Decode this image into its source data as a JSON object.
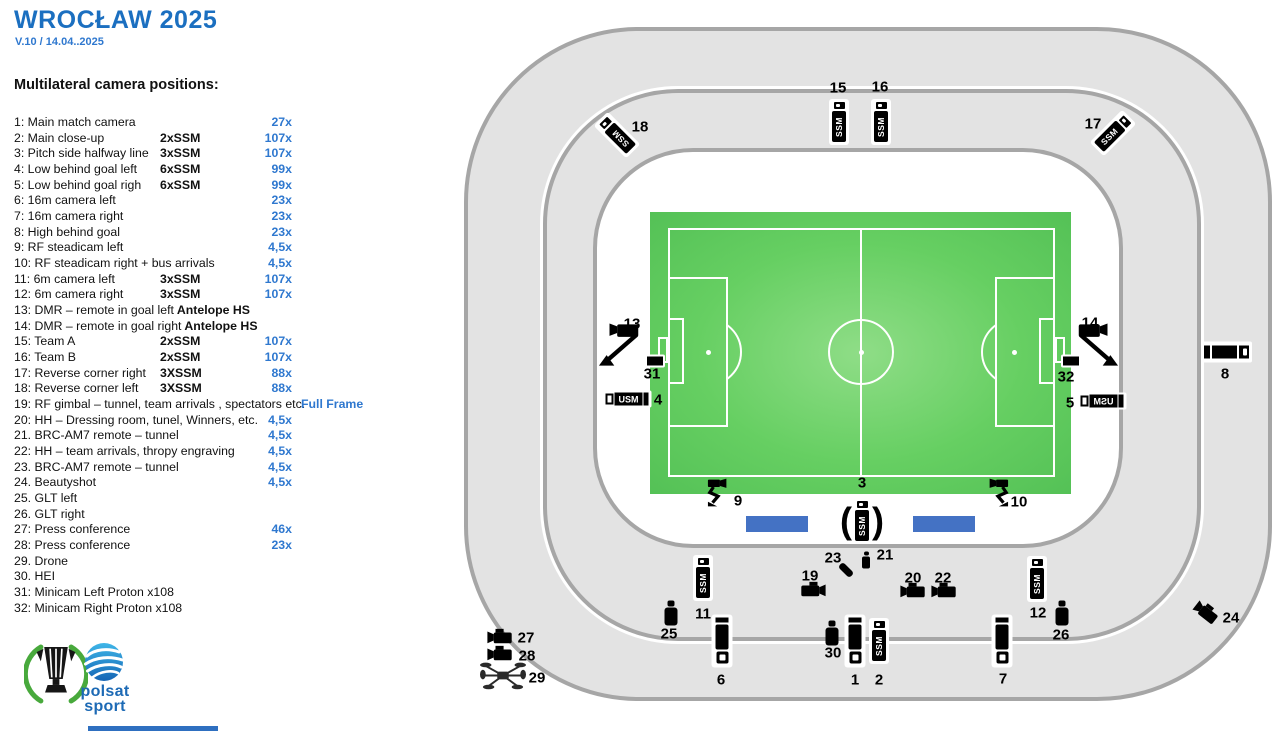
{
  "header": {
    "title": "WROCŁAW 2025",
    "version": "V.10 / 14.04..2025"
  },
  "list": {
    "heading": "Multilateral camera positions:",
    "rows": [
      {
        "n": "1:",
        "name": "Main match camera",
        "spec": "",
        "value": "27x"
      },
      {
        "n": "2:",
        "name": "Main close-up",
        "spec": "2xSSM",
        "value": "107x"
      },
      {
        "n": "3:",
        "name": "Pitch side halfway line",
        "spec": "3xSSM",
        "value": "107x"
      },
      {
        "n": "4:",
        "name": "Low behind goal left",
        "spec": "6xSSM",
        "value": "99x"
      },
      {
        "n": "5:",
        "name": "Low behind goal righ",
        "spec": "6xSSM",
        "value": "99x"
      },
      {
        "n": "6:",
        "name": "16m camera left",
        "spec": "",
        "value": "23x"
      },
      {
        "n": "7:",
        "name": "16m camera right",
        "spec": "",
        "value": "23x"
      },
      {
        "n": "8:",
        "name": "High behind goal",
        "spec": "",
        "value": "23x"
      },
      {
        "n": "9:",
        "name": "RF steadicam left",
        "spec": "",
        "value": "4,5x"
      },
      {
        "n": "10:",
        "name": "RF steadicam right + bus arrivals",
        "spec": "",
        "value": "4,5x"
      },
      {
        "n": "11:",
        "name": "6m camera left",
        "spec": "3xSSM",
        "value": "107x"
      },
      {
        "n": "12:",
        "name": "6m camera right",
        "spec": "3xSSM",
        "value": "107x"
      },
      {
        "n": "13:",
        "name": "DMR – remote in goal left",
        "suffix": " Antelope HS",
        "spec": "",
        "value": ""
      },
      {
        "n": "14:",
        "name": "DMR – remote in goal right",
        "suffix": " Antelope HS",
        "spec": "",
        "value": ""
      },
      {
        "n": "15:",
        "name": "Team A",
        "spec": "2xSSM",
        "value": "107x"
      },
      {
        "n": "16:",
        "name": "Team B",
        "spec": "2xSSM",
        "value": "107x"
      },
      {
        "n": "17:",
        "name": "Reverse corner right",
        "spec": "3XSSM",
        "value": "88x"
      },
      {
        "n": "18:",
        "name": "Reverse corner left",
        "spec": "3XSSM",
        "value": "88x"
      },
      {
        "n": "19:",
        "name": "RF gimbal – tunnel, team arrivals , spectators etc.",
        "spec": "",
        "value": "Full Frame",
        "wide": true
      },
      {
        "n": "20:",
        "name": "HH – Dressing room, tunel, Winners, etc.",
        "spec": "",
        "value": "4,5x"
      },
      {
        "n": "21.",
        "name": "BRC-AM7 remote – tunnel",
        "spec": "",
        "value": "4,5x"
      },
      {
        "n": "22:",
        "name": "HH – team arrivals, thropy engraving",
        "spec": "",
        "value": "4,5x"
      },
      {
        "n": "23.",
        "name": "BRC-AM7 remote – tunnel",
        "spec": "",
        "value": "4,5x"
      },
      {
        "n": "24.",
        "name": "Beautyshot",
        "spec": "",
        "value": "4,5x"
      },
      {
        "n": "25.",
        "name": "GLT left",
        "spec": "",
        "value": ""
      },
      {
        "n": "26.",
        "name": "GLT right",
        "spec": "",
        "value": ""
      },
      {
        "n": "27:",
        "name": "Press conference",
        "spec": "",
        "value": "46x"
      },
      {
        "n": "28:",
        "name": "Press conference",
        "spec": "",
        "value": "23x"
      },
      {
        "n": "29.",
        "name": "Drone",
        "spec": "",
        "value": ""
      },
      {
        "n": "30.",
        "name": "HEI",
        "spec": "",
        "value": ""
      },
      {
        "n": "31:",
        "name": "Minicam Left Proton x108",
        "spec": "",
        "value": ""
      },
      {
        "n": "32:",
        "name": "Minicam Right Proton x108",
        "spec": "",
        "value": ""
      }
    ]
  },
  "colors": {
    "title_blue": "#1b6fc0",
    "value_blue": "#2f78cf",
    "bench_blue": "#4472c4",
    "pitch_green": "#5ec95e",
    "stand_gray": "#e3e3e3",
    "stand_border_gray": "#a6a6a6"
  },
  "stadium": {
    "ssm_label": "SSM",
    "usm_label": "USM",
    "benches": [
      {
        "x": 746,
        "y": 516,
        "w": 62,
        "h": 16
      },
      {
        "x": 913,
        "y": 516,
        "w": 62,
        "h": 16
      }
    ],
    "cameras": [
      {
        "num": "1",
        "type": "bigcam",
        "x": 855,
        "y": 641,
        "lx": 855,
        "ly": 680
      },
      {
        "num": "2",
        "type": "ssmv",
        "x": 879,
        "y": 641,
        "lx": 879,
        "ly": 680
      },
      {
        "num": "3",
        "type": "ssmv_paren",
        "x": 862,
        "y": 521,
        "lx": 862,
        "ly": 483
      },
      {
        "num": "4",
        "type": "usmh",
        "x": 627,
        "y": 399,
        "lx": 658,
        "ly": 400
      },
      {
        "num": "5",
        "type": "usmh",
        "flip": true,
        "x": 1102,
        "y": 401,
        "lx": 1070,
        "ly": 403
      },
      {
        "num": "6",
        "type": "bigcam",
        "x": 722,
        "y": 641,
        "lx": 721,
        "ly": 680
      },
      {
        "num": "7",
        "type": "bigcam",
        "x": 1002,
        "y": 641,
        "lx": 1003,
        "ly": 679
      },
      {
        "num": "8",
        "type": "cam8",
        "x": 1227,
        "y": 352,
        "lx": 1225,
        "ly": 374
      },
      {
        "num": "9",
        "type": "steadicam",
        "x": 719,
        "y": 495,
        "lx": 738,
        "ly": 501
      },
      {
        "num": "10",
        "type": "steadicam",
        "flip": true,
        "x": 997,
        "y": 495,
        "lx": 1019,
        "ly": 502
      },
      {
        "num": "11",
        "type": "ssmv",
        "x": 703,
        "y": 578,
        "lx": 703,
        "ly": 614
      },
      {
        "num": "12",
        "type": "ssmv",
        "x": 1037,
        "y": 579,
        "lx": 1038,
        "ly": 613
      },
      {
        "num": "13",
        "type": "tripod",
        "x": 621,
        "y": 348,
        "lx": 632,
        "ly": 324
      },
      {
        "num": "14",
        "type": "tripod",
        "flip": true,
        "x": 1096,
        "y": 348,
        "lx": 1090,
        "ly": 323
      },
      {
        "num": "15",
        "type": "ssmv",
        "x": 839,
        "y": 122,
        "lx": 838,
        "ly": 88
      },
      {
        "num": "16",
        "type": "ssmv",
        "x": 881,
        "y": 122,
        "lx": 880,
        "ly": 87
      },
      {
        "num": "17",
        "type": "ssmv",
        "rot": 45,
        "x": 1113,
        "y": 133,
        "lx": 1093,
        "ly": 124
      },
      {
        "num": "18",
        "type": "ssmv",
        "rot": -45,
        "x": 617,
        "y": 135,
        "lx": 640,
        "ly": 127
      },
      {
        "num": "19",
        "type": "camcorder",
        "dir": "r",
        "x": 813,
        "y": 592,
        "lx": 810,
        "ly": 576
      },
      {
        "num": "20",
        "type": "camcorder",
        "dir": "l",
        "x": 913,
        "y": 593,
        "lx": 913,
        "ly": 578
      },
      {
        "num": "21",
        "type": "mic",
        "x": 866,
        "y": 560,
        "lx": 885,
        "ly": 555
      },
      {
        "num": "22",
        "type": "camcorder",
        "dir": "l",
        "x": 944,
        "y": 593,
        "lx": 943,
        "ly": 578
      },
      {
        "num": "23",
        "type": "pilld",
        "x": 846,
        "y": 570,
        "lx": 833,
        "ly": 558
      },
      {
        "num": "24",
        "type": "camcorder",
        "dir": "l",
        "rot": 38,
        "x": 1205,
        "y": 614,
        "lx": 1231,
        "ly": 618
      },
      {
        "num": "25",
        "type": "bottle",
        "x": 671,
        "y": 613,
        "lx": 669,
        "ly": 634
      },
      {
        "num": "26",
        "type": "bottle",
        "x": 1062,
        "y": 613,
        "lx": 1061,
        "ly": 635
      },
      {
        "num": "27",
        "type": "camcorder",
        "dir": "l",
        "x": 500,
        "y": 639,
        "lx": 526,
        "ly": 638
      },
      {
        "num": "28",
        "type": "camcorder",
        "dir": "l",
        "x": 500,
        "y": 656,
        "lx": 527,
        "ly": 656
      },
      {
        "num": "29",
        "type": "drone",
        "x": 503,
        "y": 678,
        "lx": 537,
        "ly": 678
      },
      {
        "num": "30",
        "type": "bottle",
        "x": 832,
        "y": 633,
        "lx": 833,
        "ly": 653
      },
      {
        "num": "31",
        "type": "minicam",
        "x": 655,
        "y": 361,
        "lx": 652,
        "ly": 374
      },
      {
        "num": "32",
        "type": "minicam",
        "x": 1071,
        "y": 361,
        "lx": 1066,
        "ly": 377
      }
    ]
  },
  "logos": {
    "conference_league": "uefa-conference-league-trophy",
    "polsat_line1": "polsat",
    "polsat_line2": "sport"
  }
}
